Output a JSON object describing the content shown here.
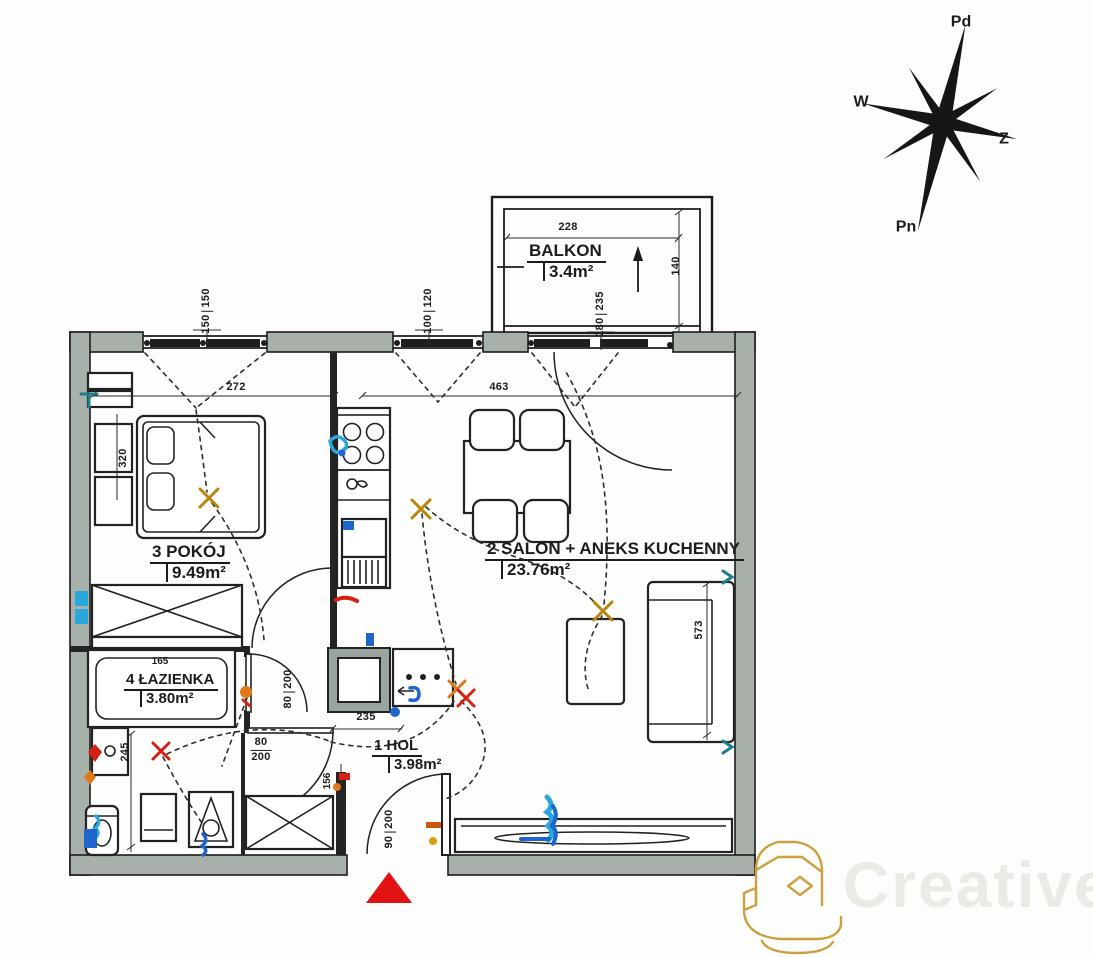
{
  "compass": {
    "top": "Pd",
    "left": "W",
    "right": "Z",
    "bottom": "Pn"
  },
  "rooms": {
    "balkon": {
      "title": "BALKON",
      "area": "3.4m²"
    },
    "pokoj": {
      "title": "3 POKÓJ",
      "area": "9.49m²"
    },
    "salon": {
      "title": "2 SALON + ANEKS KUCHENNY",
      "area": "23.76m²"
    },
    "lazienka": {
      "title": "4 ŁAZIENKA",
      "area": "3.80m²"
    },
    "hol": {
      "title": "1 HOL",
      "area": "3.98m²"
    }
  },
  "dims": {
    "balcony_width": "228",
    "balcony_depth": "140",
    "balcony_door": {
      "w": "180",
      "h": "235"
    },
    "bedroom_window": {
      "w": "150",
      "h": "150"
    },
    "kitchen_window": {
      "w": "100",
      "h": "120"
    },
    "bedroom_width": "272",
    "salon_width": "463",
    "bedroom_depth": "320",
    "sofa_wall": "573",
    "bathtub": "165",
    "bathroom_depth": "245",
    "hall": "235",
    "entry": "156",
    "bathroom_door": {
      "w": "80",
      "h": "200"
    },
    "hall_door": {
      "w": "80",
      "h": "200"
    },
    "entrance_door": {
      "w": "90",
      "h": "200"
    }
  },
  "watermark": {
    "text": "Creative"
  },
  "colors": {
    "wall": "#a7b1aa",
    "line": "#1c1c1c",
    "lamp": "#b8860b",
    "red": "#d42015",
    "orange": "#e07818",
    "blue": "#1f66cc",
    "cyan": "#2aa7dd",
    "teal": "#1b7f8c",
    "triangle": "#e01212",
    "gold": "#c9a23f",
    "wm-text": "#eceae5"
  }
}
